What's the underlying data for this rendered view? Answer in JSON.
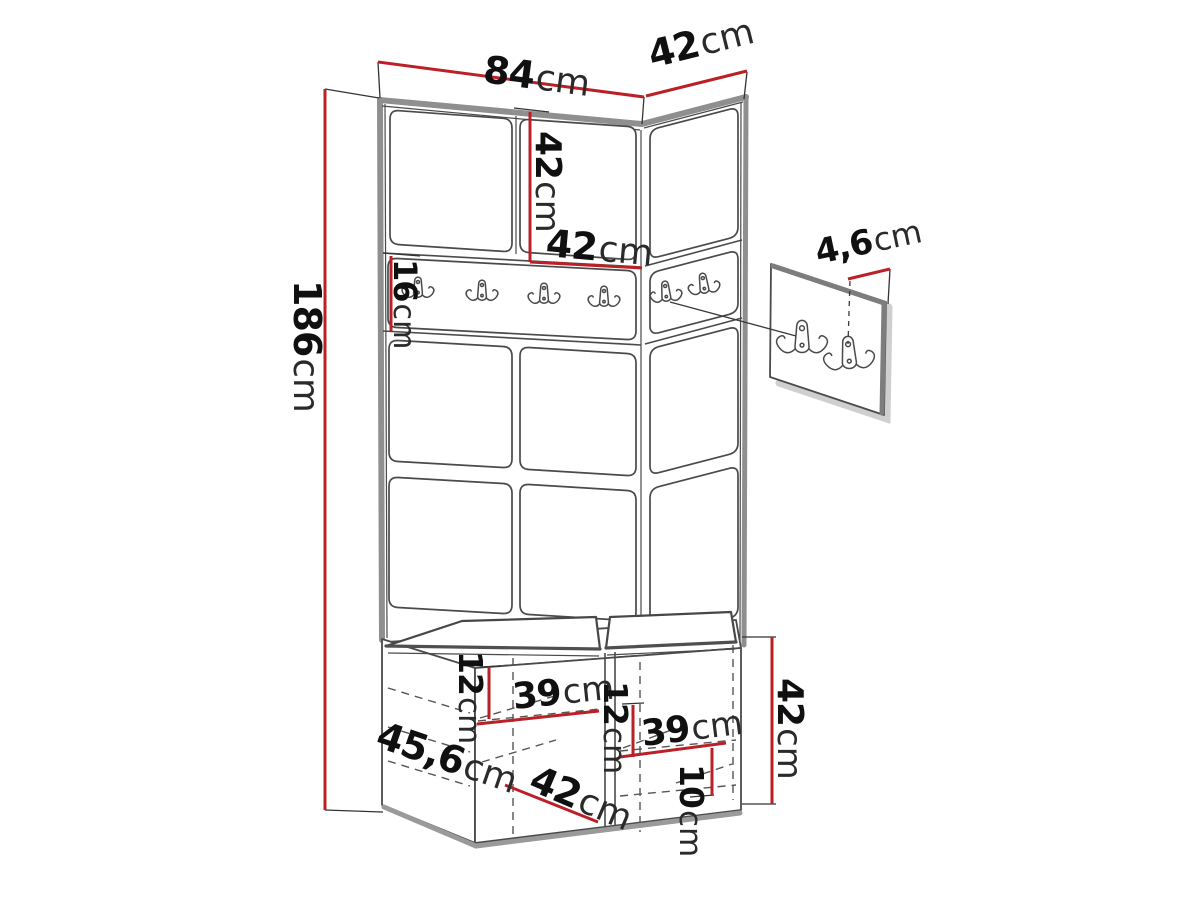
{
  "diagram": {
    "type": "furniture-dimension-sketch",
    "subject": "hallway wardrobe wall unit with coat hook rail, upholstered panels and shoe bench",
    "rail_hook_count": 6,
    "detail_hook_count": 2,
    "colors": {
      "dimension_line": "#bb2026",
      "sketch_line": "#4a4a4a",
      "edge_gray": "#8f8f8f",
      "background": "#ffffff"
    }
  },
  "dimensions": {
    "top_width": {
      "value": "84",
      "unit": "cm"
    },
    "top_depth": {
      "value": "42",
      "unit": "cm"
    },
    "cabinet_height": {
      "value": "42",
      "unit": "cm"
    },
    "cabinet_width": {
      "value": "42",
      "unit": "cm"
    },
    "rail_height": {
      "value": "16",
      "unit": "cm"
    },
    "total_height": {
      "value": "186",
      "unit": "cm"
    },
    "detail_offset": {
      "value": "4,6",
      "unit": "cm"
    },
    "bench_depth": {
      "value": "45,6",
      "unit": "cm"
    },
    "left_drop": {
      "value": "12",
      "unit": "cm"
    },
    "left_width": {
      "value": "39",
      "unit": "cm"
    },
    "bench_width": {
      "value": "42",
      "unit": "cm"
    },
    "right_drop": {
      "value": "12",
      "unit": "cm"
    },
    "right_width": {
      "value": "39",
      "unit": "cm"
    },
    "bottom_gap": {
      "value": "10",
      "unit": "cm"
    },
    "bench_height": {
      "value": "42",
      "unit": "cm"
    }
  }
}
